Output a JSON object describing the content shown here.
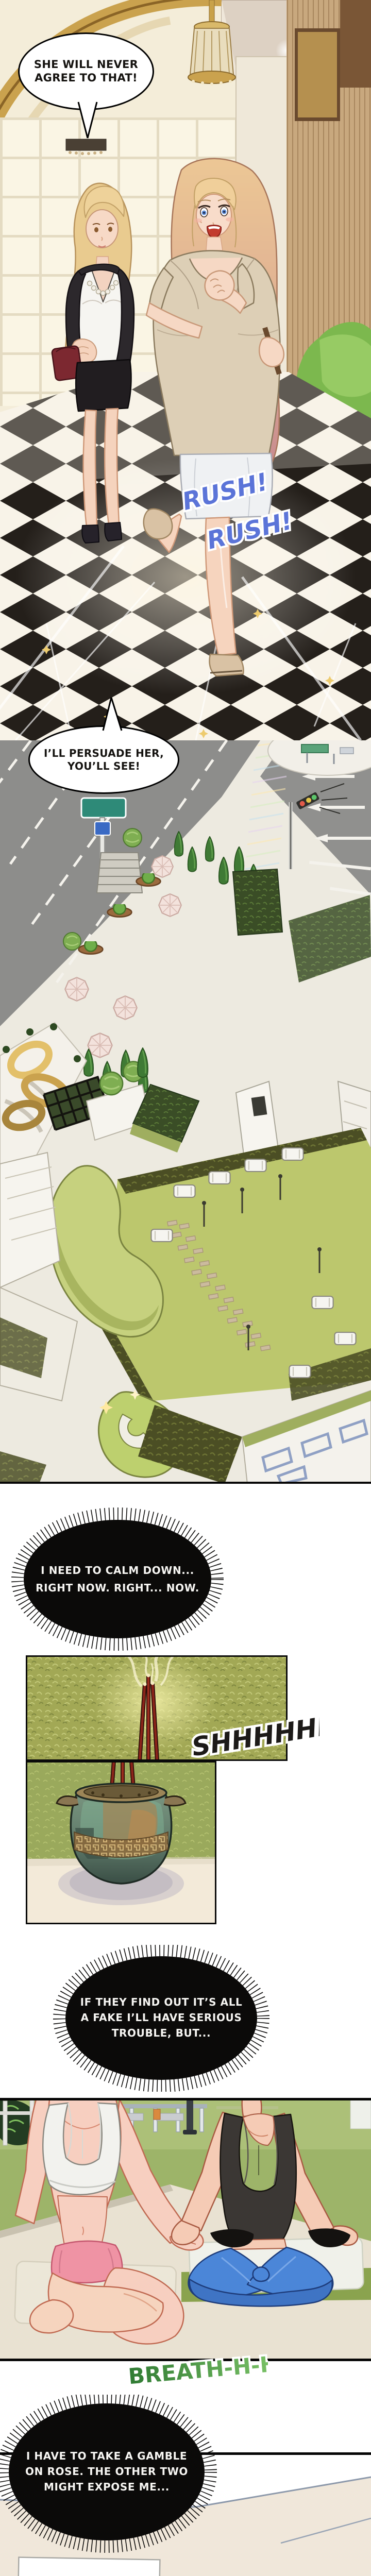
{
  "page": {
    "kind": "webtoon-comic-page",
    "background": "#ffffff"
  },
  "colors": {
    "rush_blue": "#5b74d8",
    "sfx_black": "#1c1a18",
    "breath_green_dark": "#2f7a33",
    "breath_green_light": "#7cc468",
    "thought_bubble_black": "#0b0a09",
    "gold_accent": "#d9b25c",
    "lawn_green": "#bcc76d",
    "hedge_olive": "#a2a855",
    "pants_blue": "#4b86d8"
  },
  "panel_mall": {
    "bubble_agree": {
      "line1": "SHE WILL NEVER",
      "line2": "AGREE TO THAT!"
    },
    "sfx_rush": {
      "line1": "RUSH!",
      "line2": "RUSH!"
    }
  },
  "panel_plaza": {
    "bubble_persuade": {
      "line1": "I’LL PERSUADE HER,",
      "line2": "YOU’LL SEE!"
    }
  },
  "thought_calm": {
    "line1": "I NEED TO CALM DOWN...",
    "line2": "RIGHT NOW. RIGHT... NOW."
  },
  "panel_incense": {
    "sfx_shh": "SHHHHHH!"
  },
  "thought_fake": {
    "line1": "IF THEY FIND OUT IT’S ALL",
    "line2": "A FAKE I’LL HAVE SERIOUS",
    "line3": "TROUBLE, BUT..."
  },
  "panel_yoga": {
    "sfx_breath": "BREATH-H-H"
  },
  "thought_gamble": {
    "line1": "I HAVE TO TAKE A GAMBLE",
    "line2": "ON ROSE. THE OTHER TWO",
    "line3": "MIGHT EXPOSE ME..."
  }
}
